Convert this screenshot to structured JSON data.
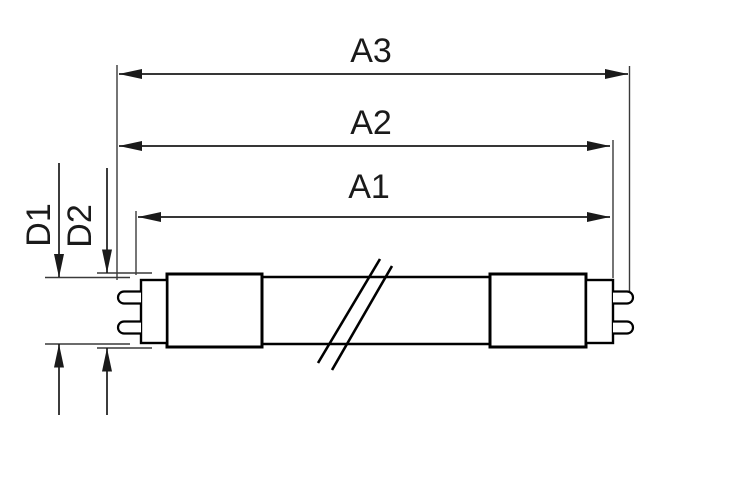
{
  "diagram": {
    "labels": {
      "a3": "A3",
      "a2": "A2",
      "a1": "A1",
      "d1": "D1",
      "d2": "D2"
    },
    "colors": {
      "line": "#000000",
      "dimension_line": "#1a1a1a",
      "background": "#ffffff"
    }
  }
}
